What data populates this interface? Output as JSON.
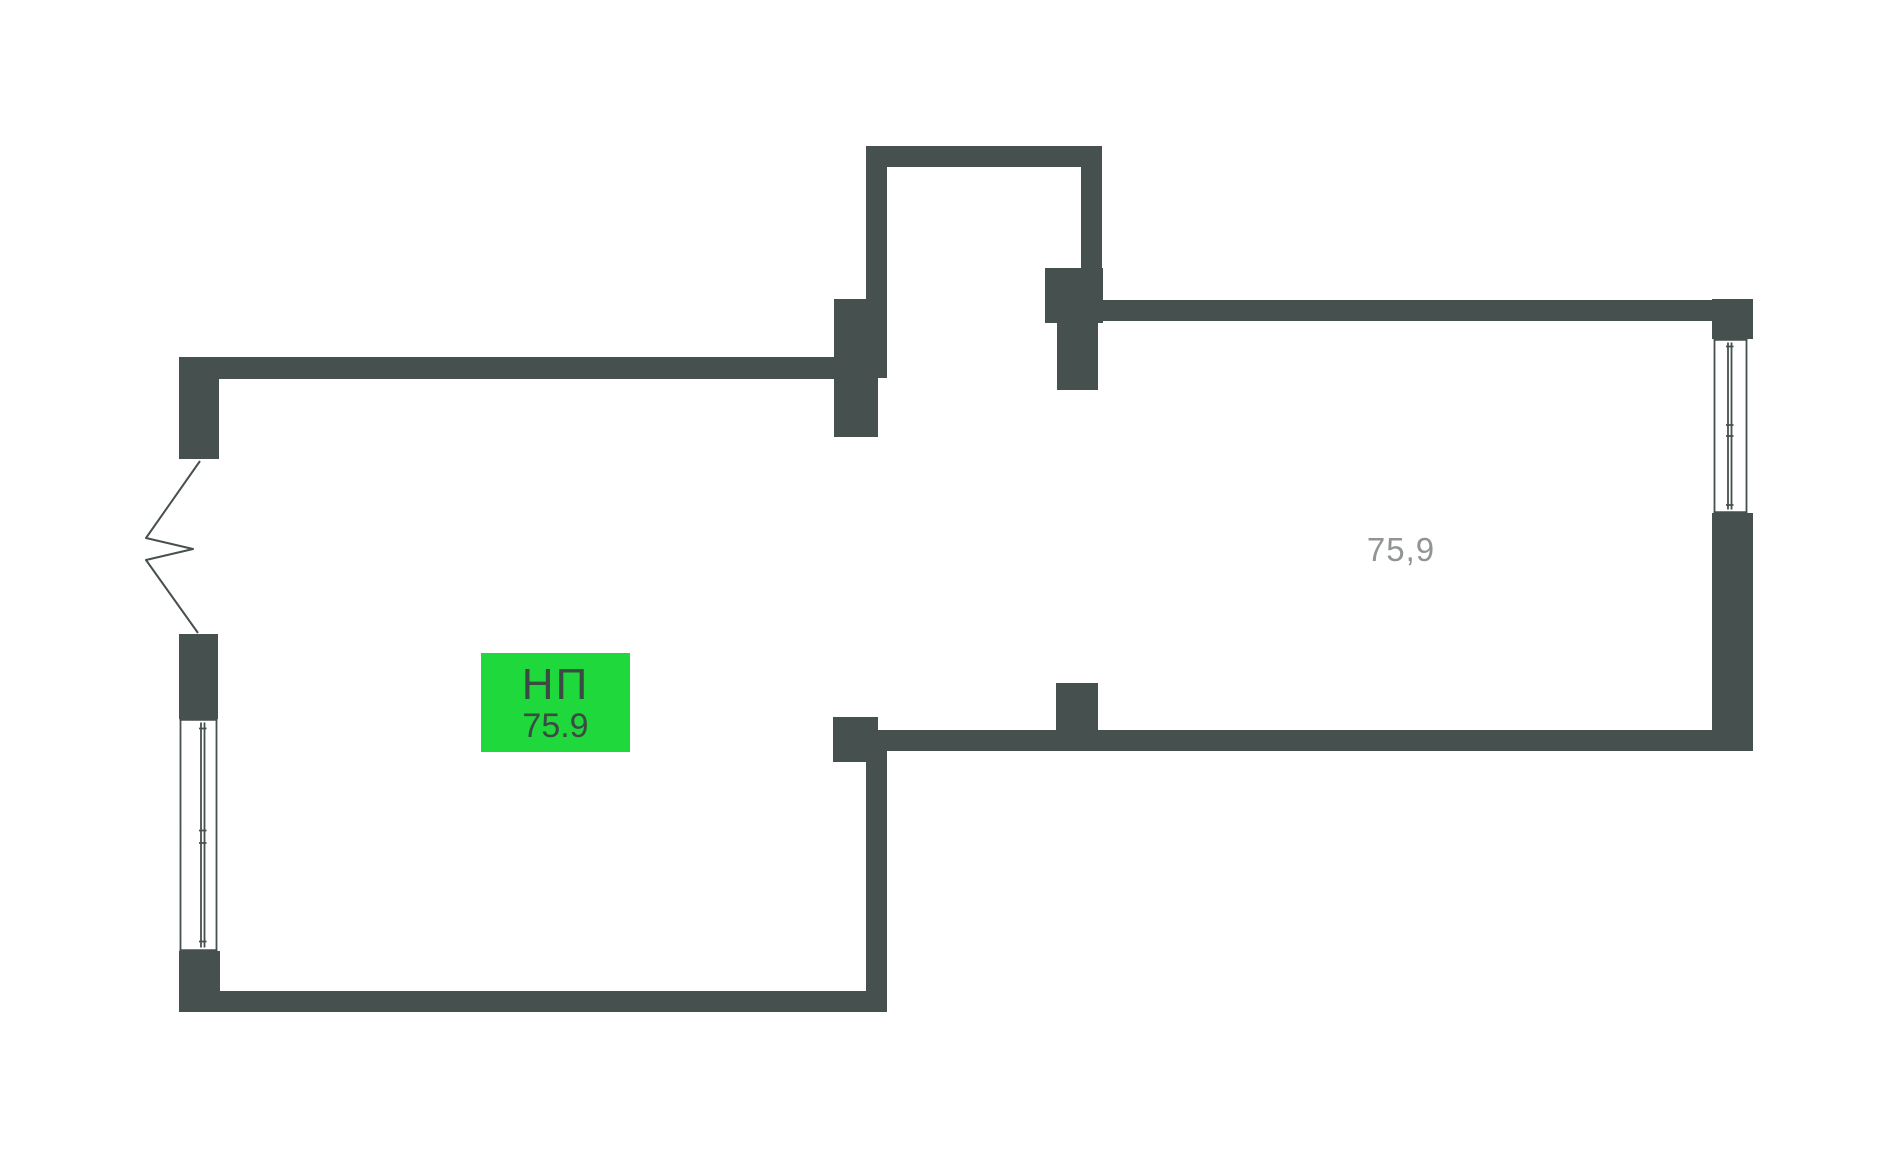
{
  "plan": {
    "unit_label": {
      "type": "НП",
      "area": "75.9",
      "bg": "#1fd83c",
      "text_color": "#3b4a43"
    },
    "room_area_label": "75,9",
    "colors": {
      "wall": "#46504f",
      "line": "#46504f",
      "background": "#ffffff",
      "area_text": "#909493"
    }
  }
}
